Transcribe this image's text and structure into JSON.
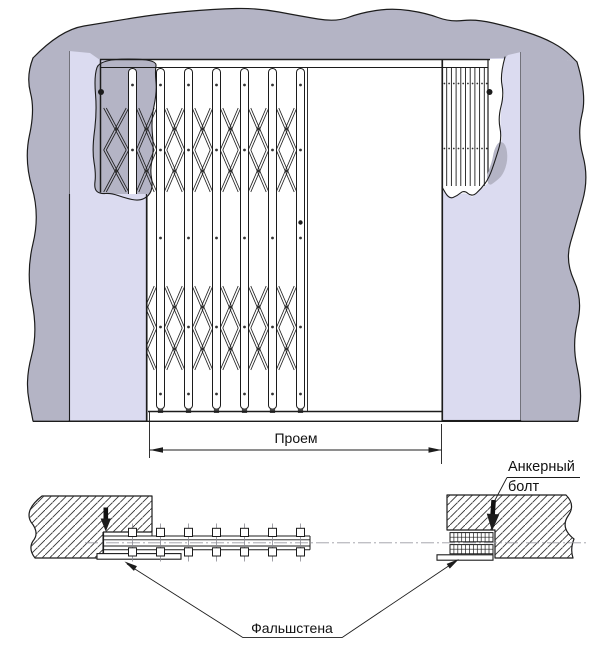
{
  "labels": {
    "opening_dimension": "Проем",
    "anchor_bolt": "Анкерный болт",
    "false_wall": "Фальшстена"
  },
  "colors": {
    "wall_fill": "#b4b4c5",
    "panel_fill": "#dbdbf0",
    "line": "#1c1c1c",
    "hatch": "#333333",
    "centerline": "#9a9aa2",
    "background": "#ffffff"
  }
}
